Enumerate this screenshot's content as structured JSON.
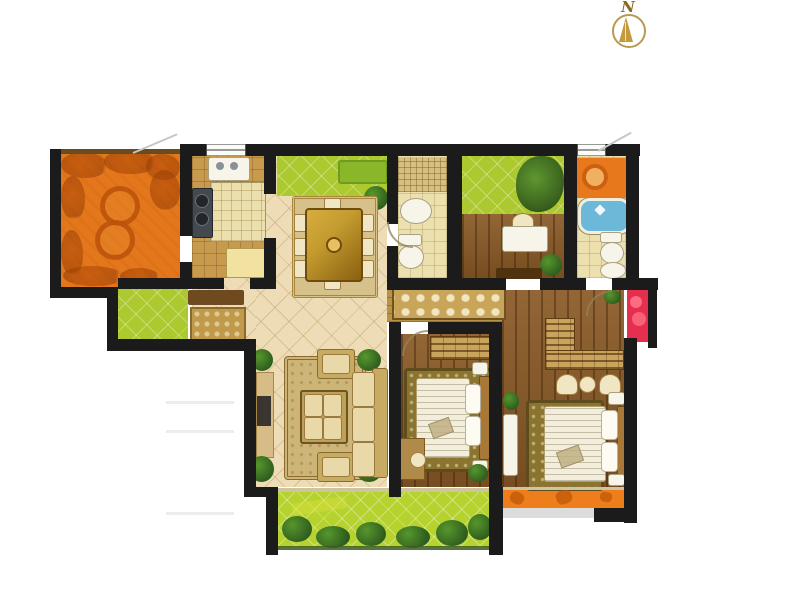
{
  "compass": {
    "label": "N"
  },
  "palette": {
    "wall": "#1b1b1b",
    "terrace": "#e4771c",
    "greenTile": "#adc930",
    "balconyGreen": "#b6d22f",
    "tileBeige": "#eddcb5",
    "woodMain": "#8a5a26",
    "woodCorridor": "#b9924a",
    "kitchenFloor": "#c79a4e",
    "counterTile": "#ecdfae",
    "stove": "#44494f",
    "fridge": "#f2e2a2",
    "bathFloor": "#ece0ae",
    "mosaic": "#d6c080",
    "tubWater": "#6cb8d8",
    "bathCounter": "#e8781c",
    "redCloset": "#e62e4e",
    "orangeBalcony": "#ee7d1b",
    "rugTan": "#d7c18b",
    "rugHall": "#c9a55a",
    "rugDark": "#8a7430",
    "tableGold": "#c29a2e",
    "furnCream": "#f0e6c4",
    "furnTan": "#d8bc88",
    "plantDark": "#2e5c1e",
    "plantLight": "#57962c",
    "mattress": "#f3eedb",
    "fixtureWhite": "#f7f4ea",
    "compassGold": "#c49a3e"
  },
  "rooms": [
    "terrace",
    "kitchen",
    "dining-area",
    "guest-bathroom",
    "study",
    "master-bathroom",
    "entry-porch",
    "entry-hall",
    "hallway",
    "living-room",
    "bedroom-2",
    "master-bedroom",
    "utility-closet",
    "south-balcony",
    "master-balcony"
  ]
}
